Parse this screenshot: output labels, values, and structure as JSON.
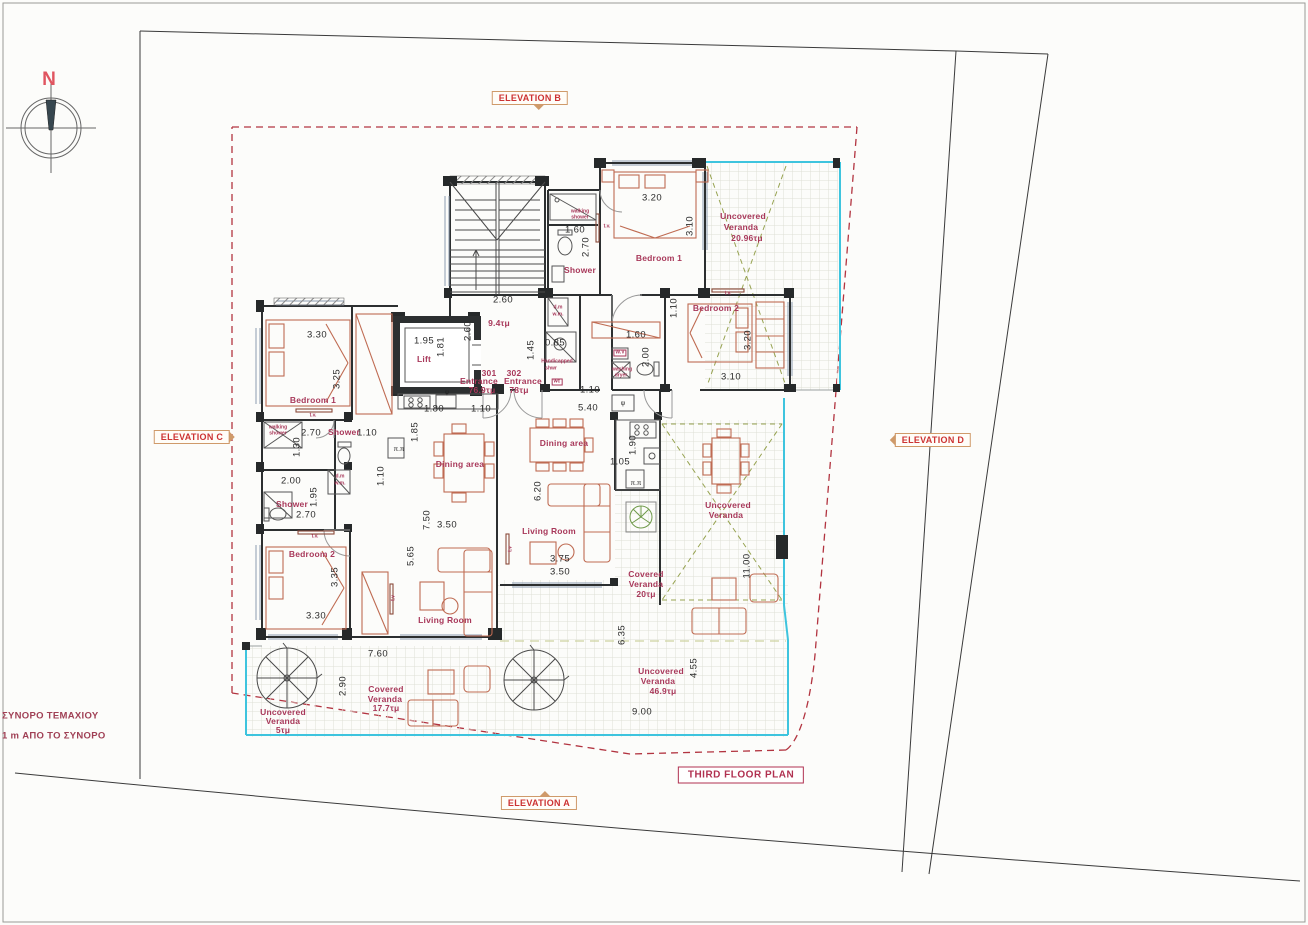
{
  "title": {
    "text": "THIRD FLOOR PLAN"
  },
  "compass": {
    "label": "N"
  },
  "colors": {
    "label_maroon": "#a8385a",
    "elevation_red": "#cc3333",
    "marker_border_tan": "#cf9a6a",
    "wall_dark": "#26292a",
    "veranda_cyan": "#3ec4de",
    "veranda_green_dash": "#97a351",
    "furniture_brick": "#bf6b52",
    "setback_red_dash": "#b23440",
    "dimension_text": "#2b2b2b"
  },
  "elevation_markers": [
    {
      "text": "ELEVATION B",
      "x": 530,
      "y": 98,
      "pointer": "down"
    },
    {
      "text": "ELEVATION C",
      "x": 192,
      "y": 437,
      "pointer": "right"
    },
    {
      "text": "ELEVATION D",
      "x": 933,
      "y": 440,
      "pointer": "left"
    },
    {
      "text": "ELEVATION A",
      "x": 539,
      "y": 803,
      "pointer": "up"
    }
  ],
  "labels": [
    {
      "t": "2.60",
      "x": 503,
      "y": 300,
      "c": "dim"
    },
    {
      "t": "2.60",
      "x": 468,
      "y": 331,
      "c": "dim",
      "r": -90
    },
    {
      "t": "3.30",
      "x": 317,
      "y": 335,
      "c": "dim"
    },
    {
      "t": "3.25",
      "x": 337,
      "y": 379,
      "c": "dim",
      "r": -90
    },
    {
      "t": "2.70",
      "x": 311,
      "y": 433,
      "c": "dim"
    },
    {
      "t": "1.10",
      "x": 367,
      "y": 433,
      "c": "dim"
    },
    {
      "t": "1.30",
      "x": 297,
      "y": 447,
      "c": "dim",
      "r": -90
    },
    {
      "t": "2.00",
      "x": 291,
      "y": 481,
      "c": "dim"
    },
    {
      "t": "1.95",
      "x": 314,
      "y": 497,
      "c": "dim",
      "r": -90
    },
    {
      "t": "2.70",
      "x": 306,
      "y": 515,
      "c": "dim"
    },
    {
      "t": "3.35",
      "x": 335,
      "y": 577,
      "c": "dim",
      "r": -90
    },
    {
      "t": "3.30",
      "x": 316,
      "y": 616,
      "c": "dim"
    },
    {
      "t": "7.60",
      "x": 378,
      "y": 654,
      "c": "dim"
    },
    {
      "t": "2.90",
      "x": 343,
      "y": 686,
      "c": "dim",
      "r": -90
    },
    {
      "t": "1.95",
      "x": 424,
      "y": 341,
      "c": "dim"
    },
    {
      "t": "1.81",
      "x": 441,
      "y": 347,
      "c": "dim",
      "r": -90
    },
    {
      "t": "1.80",
      "x": 434,
      "y": 409,
      "c": "dim"
    },
    {
      "t": "1.10",
      "x": 481,
      "y": 409,
      "c": "dim"
    },
    {
      "t": "1.85",
      "x": 415,
      "y": 432,
      "c": "dim",
      "r": -90
    },
    {
      "t": "1.10",
      "x": 381,
      "y": 476,
      "c": "dim",
      "r": -90
    },
    {
      "t": "7.50",
      "x": 427,
      "y": 520,
      "c": "dim",
      "r": -90
    },
    {
      "t": "3.50",
      "x": 447,
      "y": 525,
      "c": "dim"
    },
    {
      "t": "5.65",
      "x": 411,
      "y": 556,
      "c": "dim",
      "r": -90
    },
    {
      "t": "6.20",
      "x": 538,
      "y": 491,
      "c": "dim",
      "r": -90
    },
    {
      "t": "3.75",
      "x": 560,
      "y": 559,
      "c": "dim"
    },
    {
      "t": "3.50",
      "x": 560,
      "y": 572,
      "c": "dim"
    },
    {
      "t": "6.35",
      "x": 622,
      "y": 635,
      "c": "dim",
      "r": -90
    },
    {
      "t": "9.00",
      "x": 642,
      "y": 712,
      "c": "dim"
    },
    {
      "t": "4.55",
      "x": 694,
      "y": 668,
      "c": "dim",
      "r": -90
    },
    {
      "t": "11.00",
      "x": 747,
      "y": 566,
      "c": "dim",
      "r": -90
    },
    {
      "t": "5.40",
      "x": 588,
      "y": 408,
      "c": "dim"
    },
    {
      "t": "1.10",
      "x": 590,
      "y": 390,
      "c": "dim"
    },
    {
      "t": "1.90",
      "x": 633,
      "y": 445,
      "c": "dim",
      "r": -90
    },
    {
      "t": "1.05",
      "x": 620,
      "y": 462,
      "c": "dim"
    },
    {
      "t": "0.85",
      "x": 555,
      "y": 343,
      "c": "dim"
    },
    {
      "t": "1.45",
      "x": 531,
      "y": 350,
      "c": "dim",
      "r": -90
    },
    {
      "t": "1.60",
      "x": 575,
      "y": 230,
      "c": "dim"
    },
    {
      "t": "2.70",
      "x": 586,
      "y": 247,
      "c": "dim",
      "r": -90
    },
    {
      "t": "3.20",
      "x": 652,
      "y": 198,
      "c": "dim"
    },
    {
      "t": "3.10",
      "x": 690,
      "y": 226,
      "c": "dim",
      "r": -90
    },
    {
      "t": "1.10",
      "x": 674,
      "y": 308,
      "c": "dim",
      "r": -90
    },
    {
      "t": "1.60",
      "x": 636,
      "y": 335,
      "c": "dim"
    },
    {
      "t": "2.00",
      "x": 646,
      "y": 357,
      "c": "dim",
      "r": -90
    },
    {
      "t": "3.20",
      "x": 748,
      "y": 340,
      "c": "dim",
      "r": -90
    },
    {
      "t": "3.10",
      "x": 731,
      "y": 377,
      "c": "dim"
    },
    {
      "t": "Bedroom 1",
      "x": 313,
      "y": 400,
      "c": "room"
    },
    {
      "t": "Bedroom  2",
      "x": 312,
      "y": 554,
      "c": "room"
    },
    {
      "t": "Living Room",
      "x": 445,
      "y": 620,
      "c": "room"
    },
    {
      "t": "Dining area",
      "x": 460,
      "y": 464,
      "c": "room"
    },
    {
      "t": "Shower",
      "x": 344,
      "y": 432,
      "c": "room"
    },
    {
      "t": "Shower",
      "x": 292,
      "y": 504,
      "c": "room"
    },
    {
      "t": "Lift",
      "x": 424,
      "y": 359,
      "c": "room"
    },
    {
      "t": "9.4τμ",
      "x": 499,
      "y": 323,
      "c": "room"
    },
    {
      "t": "301",
      "x": 489,
      "y": 373,
      "c": "room"
    },
    {
      "t": "Entrance",
      "x": 479,
      "y": 381,
      "c": "room"
    },
    {
      "t": "76.9τμ",
      "x": 482,
      "y": 390,
      "c": "room"
    },
    {
      "t": "302",
      "x": 514,
      "y": 373,
      "c": "room"
    },
    {
      "t": "Entrance",
      "x": 523,
      "y": 381,
      "c": "room"
    },
    {
      "t": "78τμ",
      "x": 519,
      "y": 390,
      "c": "room"
    },
    {
      "t": "Bedroom 1",
      "x": 659,
      "y": 258,
      "c": "room"
    },
    {
      "t": "Bedroom 2",
      "x": 716,
      "y": 308,
      "c": "room"
    },
    {
      "t": "Living Room",
      "x": 549,
      "y": 531,
      "c": "room"
    },
    {
      "t": "Dining area",
      "x": 564,
      "y": 443,
      "c": "room"
    },
    {
      "t": "Shower",
      "x": 580,
      "y": 270,
      "c": "room"
    },
    {
      "t": "Uncovered",
      "x": 743,
      "y": 216,
      "c": "room"
    },
    {
      "t": "Veranda",
      "x": 741,
      "y": 227,
      "c": "room"
    },
    {
      "t": "20.96τμ",
      "x": 747,
      "y": 238,
      "c": "room"
    },
    {
      "t": "Uncovered",
      "x": 728,
      "y": 505,
      "c": "room"
    },
    {
      "t": "Veranda",
      "x": 726,
      "y": 515,
      "c": "room"
    },
    {
      "t": "Covered",
      "x": 646,
      "y": 574,
      "c": "room"
    },
    {
      "t": "Veranda",
      "x": 646,
      "y": 584,
      "c": "room"
    },
    {
      "t": "20τμ",
      "x": 646,
      "y": 594,
      "c": "room"
    },
    {
      "t": "Uncovered",
      "x": 661,
      "y": 671,
      "c": "room"
    },
    {
      "t": "Veranda",
      "x": 658,
      "y": 681,
      "c": "room"
    },
    {
      "t": "46.9τμ",
      "x": 663,
      "y": 691,
      "c": "room"
    },
    {
      "t": "Covered",
      "x": 386,
      "y": 689,
      "c": "room"
    },
    {
      "t": "Veranda",
      "x": 385,
      "y": 699,
      "c": "room"
    },
    {
      "t": "17.7τμ",
      "x": 386,
      "y": 708,
      "c": "room"
    },
    {
      "t": "Uncovered",
      "x": 283,
      "y": 712,
      "c": "room"
    },
    {
      "t": "Veranda",
      "x": 283,
      "y": 721,
      "c": "room"
    },
    {
      "t": "5τμ",
      "x": 283,
      "y": 730,
      "c": "room"
    },
    {
      "t": "walking",
      "x": 278,
      "y": 428,
      "c": "tiny"
    },
    {
      "t": "shower",
      "x": 278,
      "y": 434,
      "c": "tiny"
    },
    {
      "t": "walking",
      "x": 580,
      "y": 212,
      "c": "tiny"
    },
    {
      "t": "shower",
      "x": 580,
      "y": 218,
      "c": "tiny"
    },
    {
      "t": "d.m",
      "x": 340,
      "y": 477,
      "c": "tiny"
    },
    {
      "t": "w.m.",
      "x": 340,
      "y": 484,
      "c": "tiny"
    },
    {
      "t": "d.m",
      "x": 558,
      "y": 308,
      "c": "tiny"
    },
    {
      "t": "w.m.",
      "x": 558,
      "y": 315,
      "c": "tiny"
    },
    {
      "t": "Handicapped",
      "x": 557,
      "y": 362,
      "c": "tiny"
    },
    {
      "t": "shwr",
      "x": 551,
      "y": 369,
      "c": "tiny"
    },
    {
      "t": "wc",
      "x": 557,
      "y": 382,
      "c": "tiny box"
    },
    {
      "t": "W.V",
      "x": 620,
      "y": 353,
      "c": "tiny box"
    },
    {
      "t": "washing",
      "x": 622,
      "y": 370,
      "c": "tiny"
    },
    {
      "t": "dryer",
      "x": 621,
      "y": 376,
      "c": "tiny"
    },
    {
      "t": "t.v.",
      "x": 313,
      "y": 416,
      "c": "tiny"
    },
    {
      "t": "t.v.",
      "x": 315,
      "y": 537,
      "c": "tiny"
    },
    {
      "t": "t.v",
      "x": 394,
      "y": 598,
      "c": "tiny",
      "r": -90
    },
    {
      "t": "t.v",
      "x": 511,
      "y": 549,
      "c": "tiny",
      "r": -90
    },
    {
      "t": "t.v.",
      "x": 607,
      "y": 227,
      "c": "tiny"
    },
    {
      "t": "t.v.",
      "x": 728,
      "y": 294,
      "c": "tiny"
    },
    {
      "t": "ψ",
      "x": 447,
      "y": 393,
      "c": "unit"
    },
    {
      "t": "ψ",
      "x": 623,
      "y": 404,
      "c": "unit"
    },
    {
      "t": "π.π",
      "x": 399,
      "y": 450,
      "c": "unit"
    },
    {
      "t": "π.π",
      "x": 636,
      "y": 484,
      "c": "unit"
    },
    {
      "t": "ΣΥΝΟΡΟ ΤΕΜΑΧΙΟΥ",
      "x": 2,
      "y": 716,
      "c": "note"
    },
    {
      "t": "1 m ΑΠΟ ΤΟ ΣΥΝΟΡΟ",
      "x": 2,
      "y": 736,
      "c": "note"
    }
  ]
}
